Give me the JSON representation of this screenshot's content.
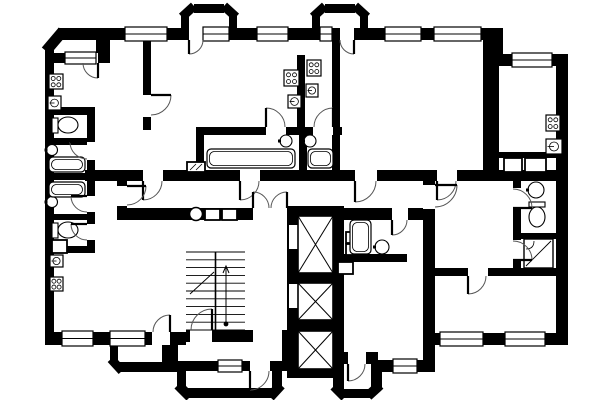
{
  "canvas": {
    "width": 600,
    "height": 400,
    "background": "#ffffff",
    "wall_color": "#000000",
    "symbol_color": "#000000",
    "arc_color": "#555555"
  },
  "plan": {
    "wall_rects": [
      [
        45,
        45,
        9,
        300
      ],
      [
        58,
        28,
        52,
        12
      ],
      [
        96,
        28,
        14,
        35
      ],
      [
        54,
        53,
        49,
        10
      ],
      [
        110,
        28,
        387,
        12
      ],
      [
        181,
        16,
        8,
        24
      ],
      [
        229,
        16,
        8,
        24
      ],
      [
        194,
        4,
        30,
        9
      ],
      [
        312,
        16,
        8,
        24
      ],
      [
        360,
        16,
        8,
        24
      ],
      [
        325,
        4,
        30,
        9
      ],
      [
        489,
        28,
        14,
        36
      ],
      [
        497,
        54,
        59,
        12
      ],
      [
        556,
        54,
        12,
        291
      ],
      [
        423,
        333,
        145,
        12
      ],
      [
        423,
        333,
        12,
        32
      ],
      [
        371,
        360,
        64,
        12
      ],
      [
        333,
        351,
        11,
        40
      ],
      [
        341,
        389,
        31,
        9
      ],
      [
        371,
        360,
        11,
        30
      ],
      [
        177,
        368,
        9,
        20
      ],
      [
        186,
        388,
        88,
        10
      ],
      [
        272,
        368,
        10,
        20
      ],
      [
        172,
        361,
        46,
        10
      ],
      [
        242,
        361,
        8,
        10
      ],
      [
        270,
        361,
        12,
        10
      ],
      [
        170,
        340,
        8,
        32
      ],
      [
        110,
        345,
        8,
        17
      ],
      [
        118,
        362,
        46,
        10
      ],
      [
        162,
        345,
        10,
        27
      ],
      [
        45,
        332,
        141,
        13
      ],
      [
        186,
        330,
        67,
        12
      ],
      [
        282,
        330,
        8,
        41
      ],
      [
        287,
        206,
        57,
        10
      ],
      [
        287,
        216,
        11,
        162
      ],
      [
        333,
        216,
        11,
        162
      ],
      [
        287,
        369,
        57,
        9
      ],
      [
        298,
        273,
        35,
        10
      ],
      [
        298,
        320,
        35,
        11
      ],
      [
        85,
        170,
        480,
        11
      ],
      [
        117,
        208,
        170,
        12
      ],
      [
        344,
        208,
        91,
        12
      ],
      [
        143,
        38,
        8,
        92
      ],
      [
        87,
        113,
        8,
        140
      ],
      [
        45,
        107,
        50,
        8
      ],
      [
        45,
        138,
        50,
        7
      ],
      [
        45,
        173,
        50,
        7
      ],
      [
        45,
        214,
        50,
        6
      ],
      [
        45,
        246,
        50,
        7
      ],
      [
        117,
        180,
        10,
        30
      ],
      [
        423,
        171,
        12,
        162
      ],
      [
        483,
        40,
        16,
        131
      ],
      [
        499,
        152,
        57,
        6
      ],
      [
        513,
        181,
        8,
        89
      ],
      [
        513,
        233,
        43,
        6
      ],
      [
        427,
        268,
        129,
        8
      ],
      [
        297,
        55,
        8,
        80
      ],
      [
        196,
        127,
        146,
        8
      ],
      [
        196,
        135,
        8,
        36
      ],
      [
        299,
        135,
        8,
        36
      ],
      [
        332,
        28,
        8,
        143
      ],
      [
        337,
        254,
        70,
        8
      ],
      [
        344,
        352,
        34,
        12
      ]
    ],
    "chamfers": [
      [
        46,
        51,
        63,
        31,
        11
      ],
      [
        182,
        17,
        194,
        6,
        9
      ],
      [
        224,
        6,
        236,
        17,
        9
      ],
      [
        313,
        17,
        325,
        6,
        9
      ],
      [
        355,
        6,
        367,
        17,
        9
      ],
      [
        111,
        359,
        122,
        371,
        9
      ],
      [
        178,
        385,
        190,
        397,
        10
      ],
      [
        270,
        397,
        281,
        385,
        10
      ],
      [
        334,
        386,
        345,
        397,
        10
      ],
      [
        368,
        396,
        380,
        385,
        10
      ]
    ],
    "gaps": [
      [
        289,
        225,
        9,
        24
      ],
      [
        289,
        284,
        9,
        24
      ]
    ],
    "windows": [
      [
        65,
        53,
        31,
        10
      ],
      [
        125,
        28,
        42,
        12
      ],
      [
        203,
        28,
        26,
        12
      ],
      [
        257,
        28,
        31,
        12
      ],
      [
        320,
        28,
        12,
        12
      ],
      [
        385,
        28,
        36,
        12
      ],
      [
        434,
        28,
        47,
        12
      ],
      [
        512,
        54,
        40,
        12
      ],
      [
        440,
        333,
        43,
        12
      ],
      [
        505,
        333,
        40,
        12
      ],
      [
        393,
        360,
        24,
        12
      ],
      [
        218,
        361,
        24,
        10
      ],
      [
        62,
        332,
        31,
        13
      ],
      [
        110,
        332,
        35,
        13
      ]
    ],
    "doors": [
      {
        "gap": [
          83,
          53,
          15,
          10
        ],
        "hx": 98,
        "hy": 63,
        "r": 15,
        "a0": 180,
        "a1": 90
      },
      {
        "gap": [
          189,
          28,
          14,
          12
        ],
        "hx": 189,
        "hy": 40,
        "r": 14,
        "a0": 0,
        "a1": 90
      },
      {
        "gap": [
          340,
          28,
          14,
          12
        ],
        "hx": 354,
        "hy": 40,
        "r": 14,
        "a0": 180,
        "a1": 90
      },
      {
        "gap": [
          143,
          170,
          20,
          11
        ],
        "hx": 143,
        "hy": 181,
        "r": 19,
        "a0": 0,
        "a1": 90
      },
      {
        "gap": [
          240,
          170,
          20,
          11
        ],
        "hx": 240,
        "hy": 181,
        "r": 19,
        "a0": 0,
        "a1": 90
      },
      {
        "gap": [
          355,
          170,
          22,
          11
        ],
        "hx": 355,
        "hy": 181,
        "r": 21,
        "a0": 0,
        "a1": 90
      },
      {
        "gap": [
          437,
          170,
          20,
          11
        ],
        "hx": 437,
        "hy": 181,
        "r": 19,
        "a0": 0,
        "a1": 90
      },
      {
        "gap": [
          143,
          95,
          8,
          22
        ],
        "hx": 151,
        "hy": 95,
        "r": 20,
        "a0": 90,
        "a1": 0
      },
      {
        "gap": [
          87,
          142,
          8,
          18
        ],
        "hx": 87,
        "hy": 142,
        "r": 17,
        "a0": 90,
        "a1": 180
      },
      {
        "gap": [
          87,
          196,
          8,
          16
        ],
        "hx": 87,
        "hy": 196,
        "r": 16,
        "a0": 90,
        "a1": 180
      },
      {
        "gap": [
          87,
          224,
          8,
          16
        ],
        "hx": 87,
        "hy": 224,
        "r": 16,
        "a0": 90,
        "a1": 180
      },
      {
        "gap": [
          117,
          186,
          10,
          20
        ],
        "hx": 127,
        "hy": 186,
        "r": 19,
        "a0": 90,
        "a1": 0
      },
      {
        "gap": [
          266,
          127,
          20,
          8
        ],
        "hx": 266,
        "hy": 127,
        "r": 19,
        "a0": 0,
        "a1": 270
      },
      {
        "gap": [
          313,
          127,
          20,
          8
        ],
        "hx": 333,
        "hy": 127,
        "r": 19,
        "a0": 180,
        "a1": 270
      },
      {
        "gap": [
          513,
          188,
          8,
          20
        ],
        "hx": 513,
        "hy": 208,
        "r": 19,
        "a0": 270,
        "a1": 0
      },
      {
        "gap": [
          513,
          240,
          8,
          20
        ],
        "hx": 513,
        "hy": 260,
        "r": 19,
        "a0": 270,
        "a1": 0
      },
      {
        "gap": [
          423,
          185,
          12,
          24
        ],
        "hx": 435,
        "hy": 185,
        "r": 22,
        "a0": 90,
        "a1": 0
      },
      {
        "gap": [
          392,
          208,
          16,
          12
        ],
        "hx": 392,
        "hy": 220,
        "r": 15,
        "a0": 0,
        "a1": 90
      },
      {
        "gap": [
          190,
          330,
          22,
          12
        ],
        "hx": 212,
        "hy": 330,
        "r": 21,
        "a0": 180,
        "a1": 270
      },
      {
        "gap": [
          250,
          361,
          20,
          10
        ],
        "hx": 250,
        "hy": 371,
        "r": 19,
        "a0": 0,
        "a1": 90
      },
      {
        "gap": [
          253,
          208,
          34,
          12
        ],
        "hx": 253,
        "hy": 208,
        "r": 16,
        "a0": 0,
        "a1": 270
      },
      {
        "gap": null,
        "hx": 287,
        "hy": 208,
        "r": 16,
        "a0": 180,
        "a1": 270
      },
      {
        "gap": [
          348,
          352,
          18,
          12
        ],
        "hx": 348,
        "hy": 364,
        "r": 17,
        "a0": 0,
        "a1": 90
      },
      {
        "gap": [
          152,
          332,
          18,
          13
        ],
        "hx": 170,
        "hy": 332,
        "r": 17,
        "a0": 180,
        "a1": 270
      },
      {
        "gap": [
          468,
          268,
          20,
          8
        ],
        "hx": 468,
        "hy": 276,
        "r": 18,
        "a0": 0,
        "a1": 90
      }
    ],
    "elevators": [
      [
        298,
        216,
        35,
        57
      ],
      [
        298,
        283,
        35,
        37
      ],
      [
        298,
        331,
        35,
        38
      ]
    ],
    "boxes": [
      {
        "r": [
          205,
          209,
          15,
          11
        ],
        "mark": "none"
      },
      {
        "r": [
          222,
          209,
          15,
          11
        ],
        "mark": "none"
      },
      {
        "r": [
          504,
          158,
          18,
          14
        ],
        "mark": "none"
      },
      {
        "r": [
          525,
          158,
          21,
          14
        ],
        "mark": "none"
      },
      {
        "r": [
          346,
          232,
          12,
          11
        ],
        "mark": "none"
      },
      {
        "r": [
          346,
          244,
          12,
          11
        ],
        "mark": "none"
      },
      {
        "r": [
          338,
          262,
          15,
          12
        ],
        "mark": "none"
      },
      {
        "r": [
          52,
          240,
          15,
          13
        ],
        "mark": "none"
      },
      {
        "r": [
          187,
          162,
          18,
          10
        ],
        "mark": "hatch"
      }
    ],
    "stoves": [
      [
        49,
        74,
        14,
        15
      ],
      [
        284,
        70,
        15,
        16
      ],
      [
        307,
        60,
        14,
        16
      ],
      [
        546,
        115,
        14,
        16
      ],
      [
        50,
        277,
        13,
        14
      ]
    ],
    "sinks": [
      [
        48,
        96,
        13,
        14
      ],
      [
        288,
        95,
        13,
        13
      ],
      [
        306,
        84,
        12,
        13
      ],
      [
        546,
        139,
        16,
        15
      ],
      [
        50,
        255,
        13,
        12
      ]
    ],
    "basins": [
      {
        "cx": 52,
        "cy": 150,
        "r": 5.5
      },
      {
        "cx": 52,
        "cy": 202,
        "r": 5.5
      },
      {
        "cx": 286,
        "cy": 141,
        "r": 6
      },
      {
        "cx": 310,
        "cy": 141,
        "r": 6
      },
      {
        "cx": 382,
        "cy": 247,
        "r": 7
      },
      {
        "cx": 536,
        "cy": 190,
        "r": 8
      }
    ],
    "tubs": [
      [
        49,
        157,
        36,
        15
      ],
      [
        49,
        182,
        36,
        15
      ],
      [
        207,
        149,
        88,
        19
      ],
      [
        308,
        149,
        25,
        19
      ],
      [
        350,
        220,
        21,
        34
      ]
    ],
    "toilets": [
      {
        "x": 52,
        "y": 117,
        "dir": "e"
      },
      {
        "x": 52,
        "y": 222,
        "dir": "e"
      },
      {
        "x": 529,
        "y": 202,
        "dir": "s"
      }
    ],
    "showers": [
      [
        524,
        239,
        29,
        29
      ]
    ],
    "chute": {
      "cx": 196,
      "cy": 214,
      "r": 6.5
    },
    "stairs": {
      "x1": 186,
      "x2": 245,
      "y1": 252,
      "y2": 330,
      "steps": 11,
      "mid": 215.5,
      "arrow": {
        "x": 226,
        "y1": 324,
        "y2": 266
      },
      "brk": [
        190,
        294,
        214,
        272
      ]
    }
  }
}
